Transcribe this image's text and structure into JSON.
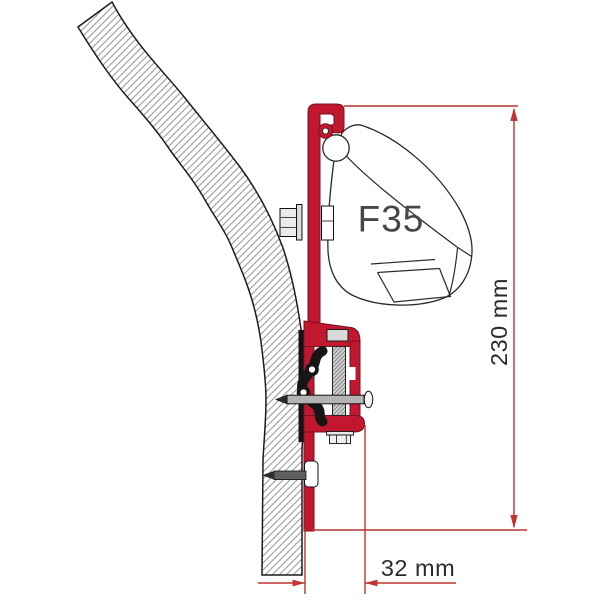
{
  "diagram": {
    "product_label": "F35",
    "dimensions": {
      "height": "230 mm",
      "width": "32 mm"
    },
    "colors": {
      "bracket_red": "#c2182f",
      "dimension_red": "#bf3434",
      "dimension_text": "#2b2b2b",
      "case_label": "#474747",
      "outline": "#1c1c1c",
      "hatch": "#9c9c9c"
    }
  }
}
